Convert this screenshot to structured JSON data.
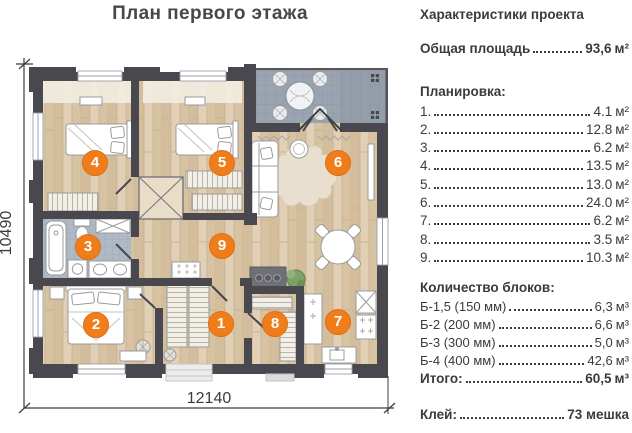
{
  "title": "План первого этажа",
  "panel": {
    "heading": "Характеристики проекта",
    "total_area": {
      "label": "Общая площадь",
      "value": "93,6",
      "unit": "м²"
    },
    "layout_heading": "Планировка:",
    "layout_items": [
      {
        "num": "1.",
        "value": "4.1",
        "unit": "м²"
      },
      {
        "num": "2.",
        "value": "12.8",
        "unit": "м²"
      },
      {
        "num": "3.",
        "value": "6.2",
        "unit": "м²"
      },
      {
        "num": "4.",
        "value": "13.5",
        "unit": "м²"
      },
      {
        "num": "5.",
        "value": "13.0",
        "unit": "м²"
      },
      {
        "num": "6.",
        "value": "24.0",
        "unit": "м²"
      },
      {
        "num": "7.",
        "value": "6.2",
        "unit": "м²"
      },
      {
        "num": "8.",
        "value": "3.5",
        "unit": "м²"
      },
      {
        "num": "9.",
        "value": "10.3",
        "unit": "м²"
      }
    ],
    "blocks_heading": "Количество блоков:",
    "block_items": [
      {
        "label": "Б-1,5 (150 мм)",
        "value": "6,3",
        "unit": "м³"
      },
      {
        "label": "Б-2 (200 мм)",
        "value": "6,6",
        "unit": "м³"
      },
      {
        "label": "Б-3 (300 мм)",
        "value": "5,0",
        "unit": "м³"
      },
      {
        "label": "Б-4 (400 мм)",
        "value": "42,6",
        "unit": "м³"
      }
    ],
    "total_blocks": {
      "label": "Итого:",
      "value": "60,5",
      "unit": "м³"
    },
    "glue": {
      "label": "Клей:",
      "value": "73 мешка"
    }
  },
  "plan": {
    "dimension_width": "12140",
    "dimension_height": "10490",
    "rooms": [
      {
        "num": "1",
        "x": 221,
        "y": 324
      },
      {
        "num": "2",
        "x": 96,
        "y": 325
      },
      {
        "num": "3",
        "x": 88,
        "y": 247
      },
      {
        "num": "4",
        "x": 95,
        "y": 163
      },
      {
        "num": "5",
        "x": 222,
        "y": 163
      },
      {
        "num": "6",
        "x": 338,
        "y": 163
      },
      {
        "num": "7",
        "x": 338,
        "y": 322
      },
      {
        "num": "8",
        "x": 275,
        "y": 324
      },
      {
        "num": "9",
        "x": 222,
        "y": 246
      }
    ],
    "colors": {
      "accent": "#f07d1b",
      "wall": "#48484e",
      "wood": "#dac7aa",
      "terrace_tile": "#9aa4b0",
      "bath_tile": "#aeb9c5"
    }
  }
}
